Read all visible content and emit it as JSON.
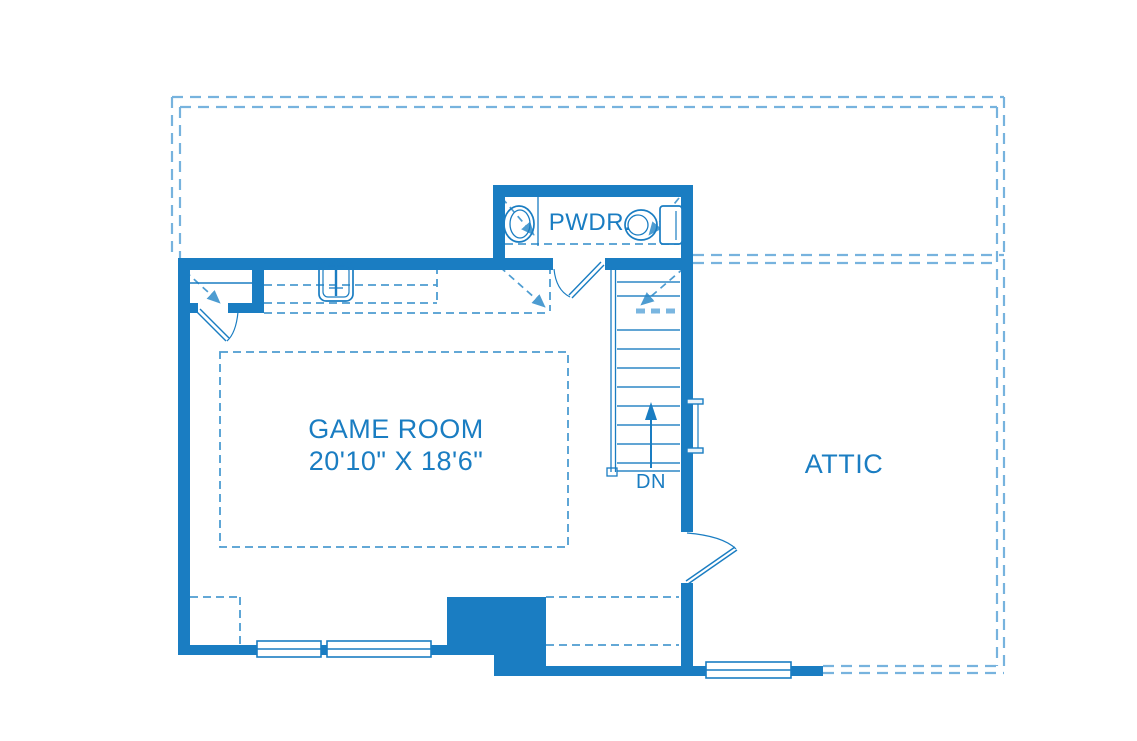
{
  "plan": {
    "type": "floor-plan",
    "colors": {
      "wall": "#1a7dc2",
      "interior_dash": "#4d9cd1",
      "boundary_dash": "#77b3de",
      "text": "#1a7dc2",
      "background": "#ffffff"
    },
    "rooms": {
      "game_room": {
        "name": "GAME ROOM",
        "dimensions": "20'10\" X 18'6\""
      },
      "powder": {
        "name": "PWDR."
      },
      "attic": {
        "name": "ATTIC"
      }
    },
    "stairs": {
      "direction_label": "DN"
    },
    "fixtures": [
      "powder-sink",
      "powder-toilet",
      "bar-sink",
      "staircase",
      "windows",
      "doors"
    ]
  }
}
